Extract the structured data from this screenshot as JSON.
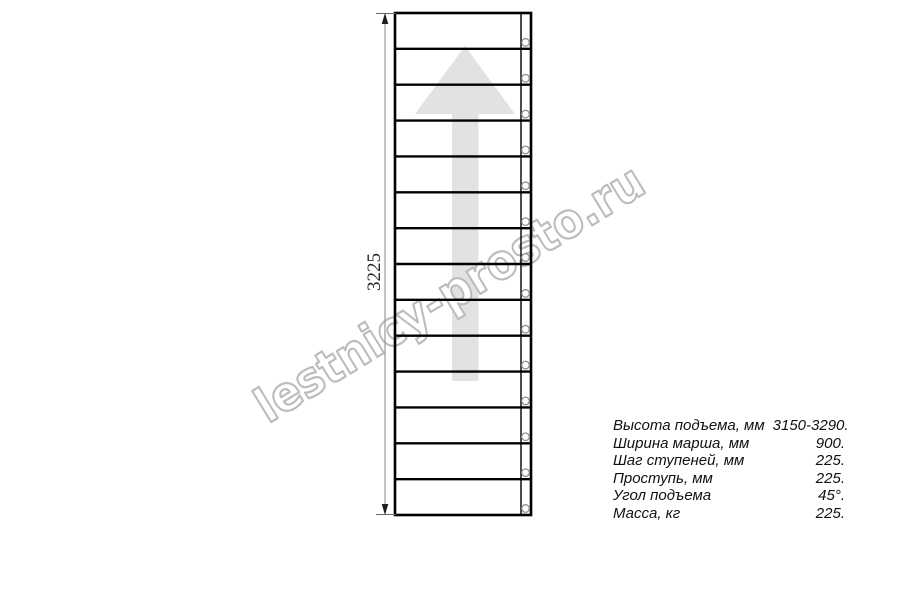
{
  "watermark": {
    "text": "lestnicy-prosto.ru"
  },
  "dimension": {
    "label": "3225"
  },
  "stairs": {
    "step_count": 14,
    "screw_count": 14,
    "direction_arrow": "up-arrow"
  },
  "colors": {
    "line": "#000000",
    "arrow_fill": "#e2e2e2",
    "watermark_outline": "#bcbcbc",
    "dimension_line": "#9a9a9a",
    "text": "#111111"
  },
  "specs": {
    "rows": [
      {
        "label": "Высота подъема, мм",
        "value": "3150-3290."
      },
      {
        "label": "Ширина марша, мм",
        "value": "900."
      },
      {
        "label": "Шаг ступеней, мм",
        "value": "225."
      },
      {
        "label": "Проступь, мм",
        "value": "225."
      },
      {
        "label": "Угол подъема",
        "value": "45°."
      },
      {
        "label": "Масса, кг",
        "value": "225."
      }
    ]
  }
}
